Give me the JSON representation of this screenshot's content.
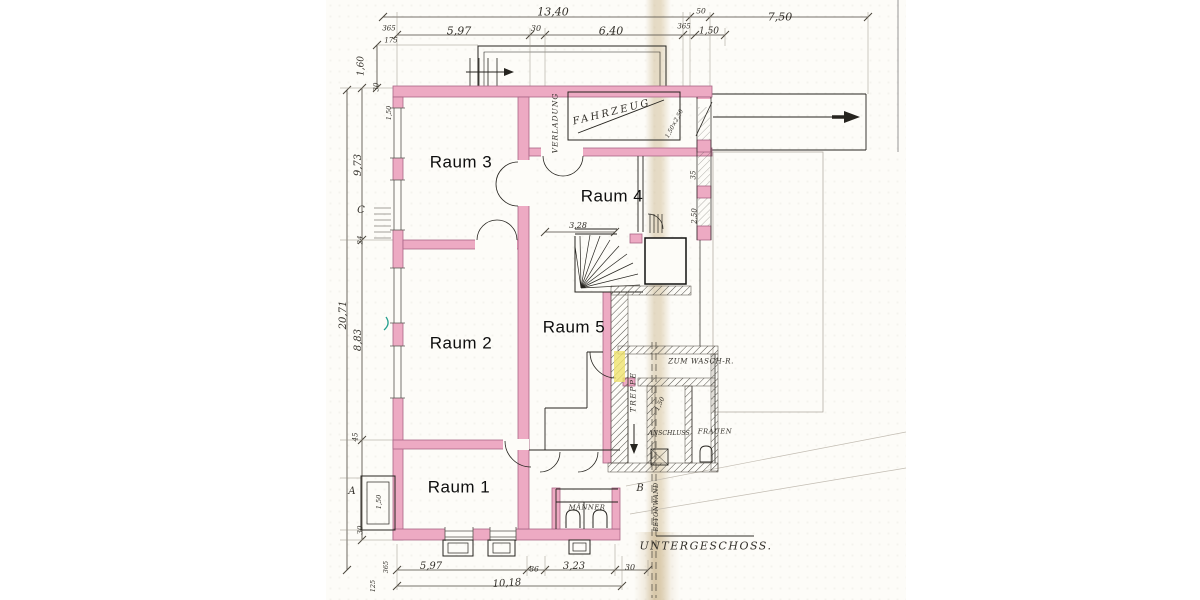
{
  "drawing": {
    "title": "UNTERGESCHOSS.",
    "type": "basement floor plan"
  },
  "colors": {
    "wall_pink": "#edaac3",
    "wall_border": "#a96686",
    "line_black": "#26241f",
    "dim_text": "#33302a",
    "hatch": "#55534d",
    "highlight_yellow": "#efe26e",
    "check_green": "#26a08f",
    "seam_tan": "#c6b086",
    "paper": "#fdfcf8"
  },
  "labels": [
    {
      "id": "room-label-raum-3",
      "text": "Raum 3",
      "x": 461,
      "y": 162,
      "rot": 0,
      "size": 17,
      "font": "room"
    },
    {
      "id": "room-label-raum-4",
      "text": "Raum 4",
      "x": 612,
      "y": 196,
      "rot": 0,
      "size": 17,
      "font": "room"
    },
    {
      "id": "room-label-raum-2",
      "text": "Raum 2",
      "x": 461,
      "y": 343,
      "rot": 0,
      "size": 17,
      "font": "room"
    },
    {
      "id": "room-label-raum-5",
      "text": "Raum 5",
      "x": 574,
      "y": 327,
      "rot": 0,
      "size": 17,
      "font": "room"
    },
    {
      "id": "room-label-raum-1",
      "text": "Raum 1",
      "x": 459,
      "y": 487,
      "rot": 0,
      "size": 17,
      "font": "room"
    },
    {
      "id": "annotation-fahrzeug",
      "text": "FAHRZEUG",
      "x": 612,
      "y": 113,
      "rot": -14,
      "size": 10,
      "font": "hand",
      "ls": 2.5
    },
    {
      "id": "annotation-verladung",
      "text": "VERLADUNG",
      "x": 555,
      "y": 123,
      "rot": -90,
      "size": 7.5,
      "font": "hand",
      "ls": 1
    },
    {
      "id": "annotation-treppe",
      "text": "TREPPE",
      "x": 633,
      "y": 392,
      "rot": -90,
      "size": 7.5,
      "font": "hand",
      "ls": 1.5
    },
    {
      "id": "annotation-anschluss",
      "text": "ANSCHLUSS",
      "x": 669,
      "y": 434,
      "rot": 0,
      "size": 6.2,
      "font": "hand"
    },
    {
      "id": "annotation-frauen",
      "text": "FRAUEN",
      "x": 715,
      "y": 432,
      "rot": 0,
      "size": 6.8,
      "font": "hand",
      "ls": 0.5
    },
    {
      "id": "annotation-maenner",
      "text": "MÄNNER",
      "x": 587,
      "y": 508,
      "rot": 0,
      "size": 6.8,
      "font": "hand",
      "ls": 0.5
    },
    {
      "id": "annotation-zum-wasch",
      "text": "ZUM WASCH-R.",
      "x": 701,
      "y": 361,
      "rot": 0,
      "size": 7.2,
      "font": "hand",
      "ls": 0.5
    },
    {
      "id": "annotation-betonwand",
      "text": "BETONWAND",
      "x": 657,
      "y": 507,
      "rot": -90,
      "size": 6.2,
      "font": "hand",
      "ls": 0.5
    },
    {
      "id": "plan-title-untergeschoss",
      "text": "UNTERGESCHOSS.",
      "x": 706,
      "y": 546,
      "rot": 0,
      "size": 11,
      "font": "hand",
      "ls": 1.5
    },
    {
      "id": "marker-a",
      "text": "A",
      "x": 352,
      "y": 492,
      "rot": 0,
      "size": 10,
      "font": "hand"
    },
    {
      "id": "marker-b",
      "text": "B",
      "x": 640,
      "y": 489,
      "rot": 0,
      "size": 10,
      "font": "hand"
    },
    {
      "id": "marker-c",
      "text": "C",
      "x": 361,
      "y": 211,
      "rot": 0,
      "size": 10,
      "font": "hand"
    },
    {
      "id": "dim-top-total",
      "text": "13,40",
      "x": 553,
      "y": 12,
      "rot": 0,
      "size": 11,
      "font": "hand"
    },
    {
      "id": "dim-top-50",
      "text": "50",
      "x": 701,
      "y": 11,
      "rot": 0,
      "size": 7.5,
      "font": "hand"
    },
    {
      "id": "dim-top-750",
      "text": "7,50",
      "x": 780,
      "y": 17,
      "rot": 0,
      "size": 11,
      "font": "hand"
    },
    {
      "id": "dim-top-365-left",
      "text": "365",
      "x": 389,
      "y": 29,
      "rot": 0,
      "size": 7,
      "font": "hand"
    },
    {
      "id": "dim-top-175",
      "text": "175",
      "x": 391,
      "y": 41,
      "rot": 0,
      "size": 7,
      "font": "hand"
    },
    {
      "id": "dim-top-597",
      "text": "5,97",
      "x": 459,
      "y": 31,
      "rot": 0,
      "size": 11,
      "font": "hand"
    },
    {
      "id": "dim-top-30",
      "text": "30",
      "x": 536,
      "y": 29,
      "rot": 0,
      "size": 8,
      "font": "hand"
    },
    {
      "id": "dim-top-640",
      "text": "6,40",
      "x": 611,
      "y": 31,
      "rot": 0,
      "size": 11,
      "font": "hand"
    },
    {
      "id": "dim-top-365-right",
      "text": "365",
      "x": 684,
      "y": 27,
      "rot": 0,
      "size": 7,
      "font": "hand"
    },
    {
      "id": "dim-top-150",
      "text": "1,50",
      "x": 709,
      "y": 32,
      "rot": 0,
      "size": 9,
      "font": "hand"
    },
    {
      "id": "dim-left-160",
      "text": "1,60",
      "x": 362,
      "y": 66,
      "rot": -90,
      "size": 9,
      "font": "hand"
    },
    {
      "id": "dim-left-30-upper",
      "text": "30",
      "x": 377,
      "y": 87,
      "rot": -90,
      "size": 7,
      "font": "hand"
    },
    {
      "id": "dim-left-150-wall",
      "text": "1,50",
      "x": 389,
      "y": 113,
      "rot": -90,
      "size": 6.5,
      "font": "hand"
    },
    {
      "id": "dim-left-973",
      "text": "9,73",
      "x": 359,
      "y": 165,
      "rot": -90,
      "size": 10,
      "font": "hand"
    },
    {
      "id": "dim-left-24",
      "text": "24",
      "x": 361,
      "y": 240,
      "rot": -90,
      "size": 7,
      "font": "hand"
    },
    {
      "id": "dim-left-2071",
      "text": "20,71",
      "x": 344,
      "y": 315,
      "rot": -90,
      "size": 10,
      "font": "hand"
    },
    {
      "id": "dim-left-883",
      "text": "8,83",
      "x": 359,
      "y": 340,
      "rot": -90,
      "size": 10,
      "font": "hand"
    },
    {
      "id": "dim-left-45",
      "text": "45",
      "x": 356,
      "y": 437,
      "rot": -90,
      "size": 7,
      "font": "hand"
    },
    {
      "id": "dim-left-150-bay",
      "text": "1,50",
      "x": 379,
      "y": 502,
      "rot": -90,
      "size": 6.5,
      "font": "hand"
    },
    {
      "id": "dim-left-30-lower",
      "text": "30",
      "x": 361,
      "y": 530,
      "rot": -90,
      "size": 7,
      "font": "hand"
    },
    {
      "id": "dim-left-365",
      "text": "365",
      "x": 386,
      "y": 567,
      "rot": -90,
      "size": 6.5,
      "font": "hand"
    },
    {
      "id": "dim-left-125",
      "text": "125",
      "x": 373,
      "y": 586,
      "rot": -90,
      "size": 6.5,
      "font": "hand"
    },
    {
      "id": "dim-bottom-597",
      "text": "5,97",
      "x": 431,
      "y": 567,
      "rot": 0,
      "size": 10,
      "font": "hand"
    },
    {
      "id": "dim-bottom-86",
      "text": "86",
      "x": 534,
      "y": 569,
      "rot": 0,
      "size": 7.5,
      "font": "hand"
    },
    {
      "id": "dim-bottom-323",
      "text": "3,23",
      "x": 574,
      "y": 567,
      "rot": 0,
      "size": 10,
      "font": "hand"
    },
    {
      "id": "dim-bottom-30",
      "text": "30",
      "x": 630,
      "y": 568,
      "rot": 0,
      "size": 8,
      "font": "hand"
    },
    {
      "id": "dim-bottom-1018",
      "text": "10,18",
      "x": 507,
      "y": 584,
      "rot": -4,
      "size": 10,
      "font": "hand"
    },
    {
      "id": "dim-inner-328",
      "text": "3,28",
      "x": 578,
      "y": 226,
      "rot": 0,
      "size": 8,
      "font": "hand"
    },
    {
      "id": "dim-right-35",
      "text": "35",
      "x": 694,
      "y": 175,
      "rot": -90,
      "size": 7,
      "font": "hand"
    },
    {
      "id": "dim-right-250",
      "text": "2,50",
      "x": 695,
      "y": 216,
      "rot": -90,
      "size": 7,
      "font": "hand"
    },
    {
      "id": "dim-treppe-150",
      "text": "1,50",
      "x": 660,
      "y": 404,
      "rot": -65,
      "size": 6.5,
      "font": "hand"
    },
    {
      "id": "dim-garage-door",
      "text": "1,50×2,50",
      "x": 675,
      "y": 124,
      "rot": -62,
      "size": 6,
      "font": "hand"
    }
  ]
}
